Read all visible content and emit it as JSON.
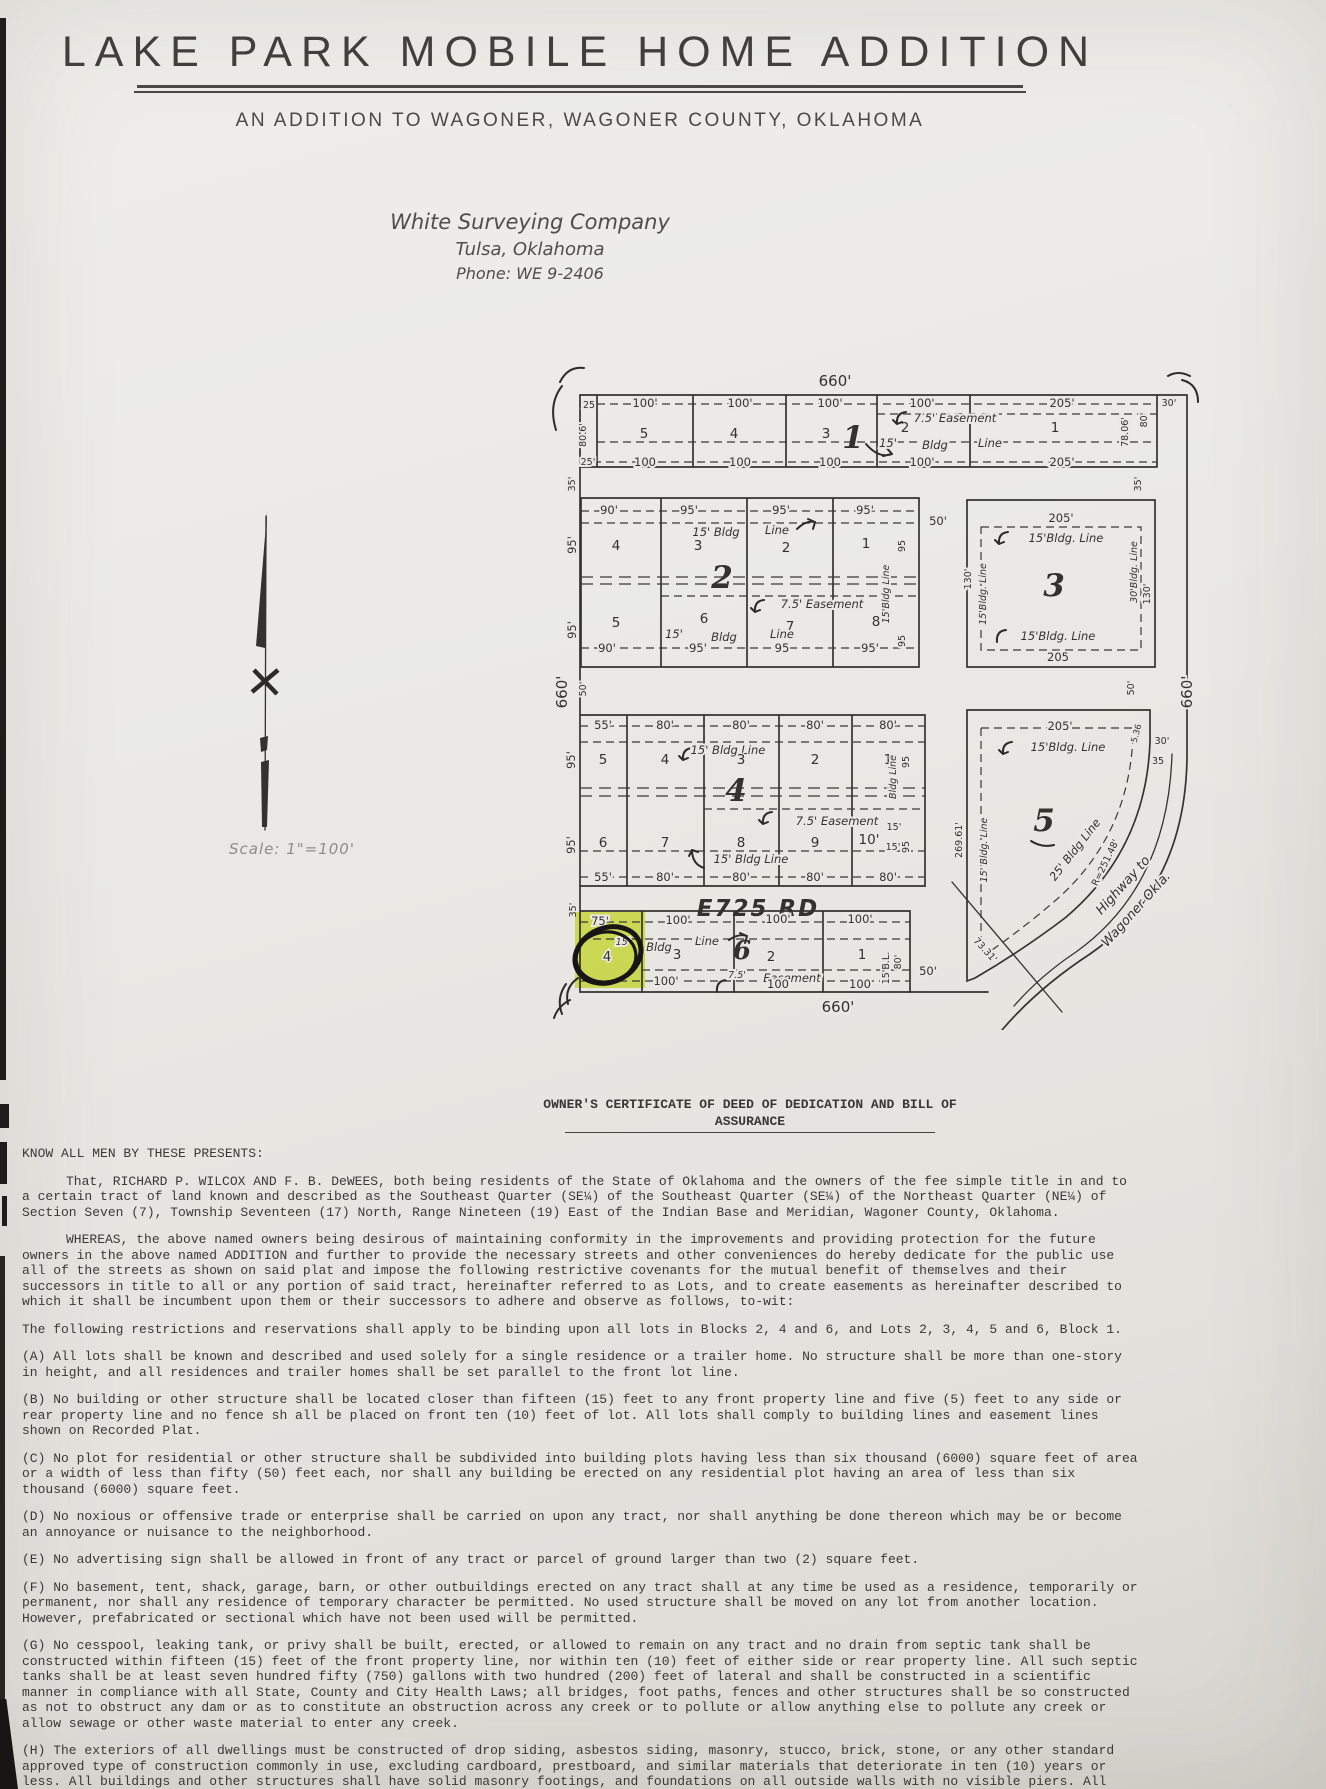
{
  "header": {
    "title": "LAKE PARK MOBILE HOME ADDITION",
    "subtitle": "AN ADDITION TO WAGONER, WAGONER COUNTY, OKLAHOMA",
    "surveyor_name": "White Surveying Company",
    "surveyor_city": "Tulsa, Oklahoma",
    "surveyor_phone": "Phone: WE 9-2406"
  },
  "plat": {
    "scale_note": "Scale: 1\"=100'",
    "street_name": "E725 RD",
    "outer": {
      "top": "660'",
      "bottom": "660'",
      "left": "660'",
      "right": "660'"
    },
    "block1": {
      "number": "1",
      "lots": [
        "5",
        "4",
        "3",
        "2",
        "1"
      ],
      "top_dims": [
        "100'",
        "100'",
        "100'",
        "100'",
        "205'"
      ],
      "bottom_dims": [
        "100",
        "100",
        "100",
        "100'",
        "205'"
      ],
      "left_top": "25",
      "left_mid": "80.6'",
      "left_bottom": "25'",
      "right_dims": [
        "78.06'",
        "80'",
        "30'"
      ],
      "easement": "7.5' Easement",
      "bldg_parts": [
        "15'",
        "Bldg",
        "Line"
      ]
    },
    "street1": {
      "left": "35'",
      "right": "35'"
    },
    "block2": {
      "number": "2",
      "top_lots": [
        "4",
        "3",
        "2",
        "1"
      ],
      "bottom_lots": [
        "5",
        "6",
        "7",
        "8"
      ],
      "top_dims": [
        "90'",
        "95'",
        "95'",
        "95'"
      ],
      "bottom_dims": [
        "90'",
        "95'",
        "95",
        "95'"
      ],
      "left_dims": [
        "95'",
        "95'"
      ],
      "right_vert": [
        "95",
        "15'Bldg Line",
        "95"
      ],
      "bldg_top": [
        "15' Bldg",
        "Line"
      ],
      "bldg_bottom": [
        "15'",
        "Bldg",
        "Line"
      ],
      "easement": "7.5' Easement",
      "street_right": "50'"
    },
    "block3": {
      "number": "3",
      "top_dim": "205'",
      "bottom_dim": "205",
      "bldg_top": "15'Bldg. Line",
      "bldg_bottom": "15'Bldg. Line",
      "left_vert": [
        "130'",
        "15'Bldg. Line"
      ],
      "right_vert": [
        "30'Bldg. Line",
        "130'"
      ]
    },
    "street2": {
      "left": "50'",
      "right": "50'"
    },
    "block4": {
      "number": "4",
      "top_lots": [
        "5",
        "4",
        "3",
        "2",
        "1"
      ],
      "bottom_lots": [
        "6",
        "7",
        "8",
        "9",
        "10'"
      ],
      "top_dims": [
        "55'",
        "80'",
        "80'",
        "80'",
        "80'"
      ],
      "bottom_dims": [
        "55'",
        "80'",
        "80'",
        "80'",
        "80'"
      ],
      "left_dims": [
        "95'",
        "95'"
      ],
      "right_vert": [
        "95",
        "Bldg Line",
        "15'",
        "95"
      ],
      "bldg_top": "15' Bldg Line",
      "bldg_bottom": "15' Bldg Line",
      "easement": "7.5' Easement",
      "extra_15": "15'"
    },
    "street3": {
      "left": "35'"
    },
    "block5": {
      "number": "5",
      "top_dim": "205'",
      "bldg_top": "15'Bldg. Line",
      "left_vert": [
        "269.61'",
        "15' Bldg. Line"
      ],
      "curve_bldg": "25' Bldg Line",
      "curve_radius": "R=251.48'",
      "dim_536": "5.36",
      "right_30": "30'",
      "right_35": "35",
      "diag_dim": "73.31'",
      "highway_line1": "Highway to",
      "highway_line2": "Wagoner Okla."
    },
    "block6": {
      "number": "6",
      "lots": [
        "4",
        "3",
        "2",
        "1"
      ],
      "top_dims": [
        "75'",
        "100'",
        "100'",
        "100'"
      ],
      "bottom_dims": [
        "100'",
        "100",
        "100"
      ],
      "bldg_parts": [
        "15'",
        "Bldg",
        "Line"
      ],
      "easement_a": "7.5'",
      "easement_b": "Easement",
      "right_vert": [
        "15'B.L.",
        "80'"
      ],
      "street_right": "50'"
    }
  },
  "certificate": {
    "heading1": "OWNER'S CERTIFICATE OF DEED OF DEDICATION AND BILL OF",
    "heading2": "ASSURANCE",
    "intro": "KNOW ALL MEN BY THESE PRESENTS:",
    "p1": "That, RICHARD P. WILCOX AND F. B. DeWEES, both being residents of the State of Oklahoma and the owners of the fee simple title in and to a certain tract of land known and described as the Southeast Quarter (SE¼) of the Southeast Quarter (SE¼) of the Northeast Quarter (NE¼) of Section Seven (7), Township Seventeen (17) North, Range Nineteen (19) East of the Indian Base and Meridian, Wagoner County, Oklahoma.",
    "p2": "WHEREAS, the above named owners being desirous of maintaining conformity in the improvements and providing protection for the future owners in the above named ADDITION and further to provide the necessary streets and other conveniences do hereby dedicate for the public use all of the streets as shown on said plat and impose the following restrictive covenants for the mutual benefit of themselves and their successors in title to all or any portion of said tract, hereinafter referred to as Lots, and to create easements as hereinafter described to which it shall be incumbent upon them or their successors to adhere and observe as follows, to-wit:",
    "p3": "The following restrictions and reservations shall apply to be binding upon all lots in Blocks 2, 4 and 6, and Lots 2, 3, 4, 5 and 6, Block 1.",
    "restrictions": [
      "(A)  All lots shall be known and described and used solely for a single residence or a trailer home.  No structure shall be more than one-story in height, and all residences and trailer homes shall be set parallel to the front lot line.",
      "(B)  No building or other structure shall be located closer than fifteen (15) feet to any front property line and five (5) feet to any side or rear property line and no fence sh all be placed on front ten (10) feet of lot.  All lots shall comply to building lines and easement lines shown on Recorded Plat.",
      "(C)  No plot for residential or other structure shall be subdivided into building plots having less than six thousand (6000) square feet of area or a width of less than fifty (50) feet each, nor shall any building be erected on any residential plot having an area of less than six thousand (6000) square feet.",
      "(D)  No noxious or offensive trade or enterprise shall be carried on upon any tract, nor shall anything be done thereon which may be or become an annoyance or nuisance to the neighborhood.",
      "(E)  No advertising sign shall be allowed in front of any tract or parcel of ground larger than two (2) square feet.",
      "(F)  No basement, tent, shack, garage, barn, or other outbuildings erected on any tract shall at any time be used as a residence, temporarily or permanent, nor shall any residence of temporary character be permitted.  No used structure shall be moved on any lot from another location.  However, prefabricated or sectional which have not been used will be permitted.",
      "(G)  No cesspool, leaking tank, or privy shall be built, erected, or allowed to remain on any tract and no drain from septic tank shall be constructed within fifteen (15) feet of the front property line, nor within ten (10) feet of either side or rear property line.  All such septic tanks shall be at least seven hundred fifty (750) gallons with two hundred (200) feet of lateral and shall be constructed in a scientific manner in compliance with all State, County and City Health Laws; all bridges, foot paths, fences and other structures shall be so constructed as not to obstruct any dam or as to constitute an obstruction across any creek or to pollute or allow anything else to pollute any creek or allow sewage or other waste material to enter any creek.",
      "(H)  The exteriors of all dwellings must be constructed of drop siding, asbestos siding, masonry, stucco, brick, stone, or any other standard approved type of construction commonly in use, excluding cardboard, prestboard, and similar materials that deteriorate in ten (10) years or less.  All buildings and other structures shall have solid masonry footings, and foundations on all outside walls with no visible piers.  All Trailer Homes shall have skirts of corrugated iron, corrugated aluminum or concrete block and shall be placed within ninety (90) days after trailer is placed on the Lot.  Skirts shall be placed on all four sides."
    ]
  }
}
